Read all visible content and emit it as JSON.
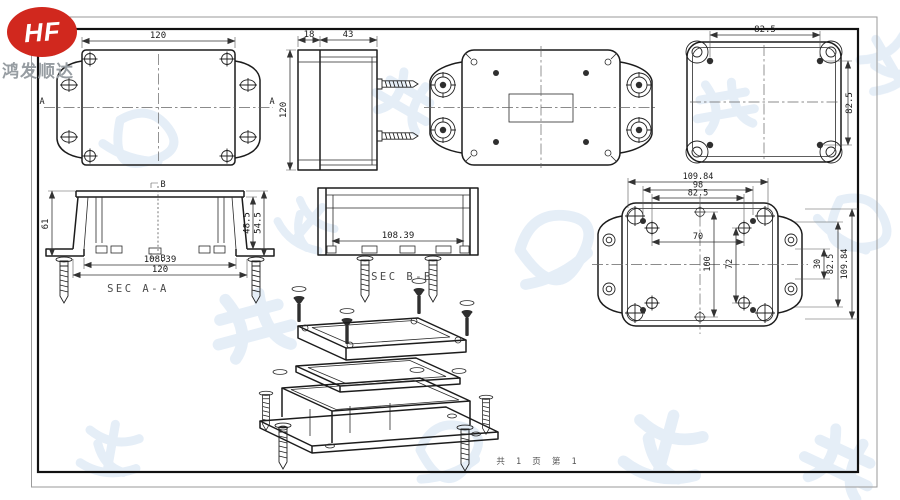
{
  "logo": {
    "brand": "HF",
    "company": "鸿发顺达"
  },
  "footer": {
    "page_info": "共 1 页  第 1"
  },
  "colors": {
    "logo_red": "#d1281e",
    "line": "#1c1c1c",
    "watermark_blue": "#e2ecf7"
  },
  "views": {
    "top": {
      "dim_width": "120",
      "marker_left": "A",
      "marker_right": "A"
    },
    "side": {
      "dim_lid": "18",
      "dim_body": "43",
      "dim_height": "120"
    },
    "lid_inner": {
      "dim_width": "82.5",
      "dim_height": "82.5"
    },
    "base_inner": {
      "dim_w1": "109.84",
      "dim_w2": "98",
      "dim_w3": "82.5",
      "dim_boss": "70",
      "dim_h1": "100",
      "dim_h2": "72",
      "dim_r1": "30",
      "dim_r2": "82.5",
      "dim_r3": "109.84"
    },
    "sec_aa": {
      "label": "SEC A-A",
      "dim_height": "61",
      "dim_d1": "48.5",
      "dim_d2": "54.5",
      "dim_w1": "108.39",
      "dim_w2": "120",
      "marker": "B"
    },
    "sec_bb": {
      "label": "SEC B-B",
      "dim_w1": "108.39"
    }
  }
}
